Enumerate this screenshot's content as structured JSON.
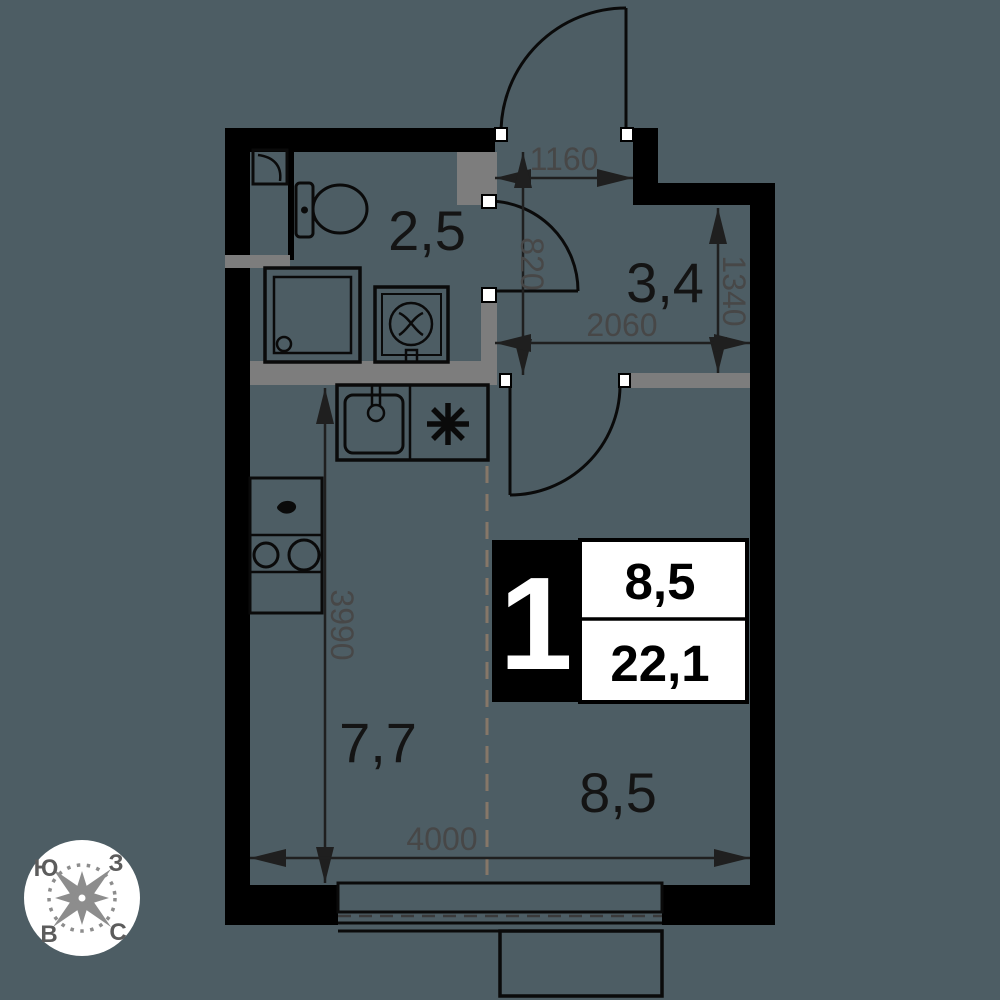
{
  "plan_title": "studio-apartment-floor-plan",
  "colors": {
    "background": "#4d5d64",
    "wall": "#000000",
    "partition": "#7d7d7d",
    "dim": "#1f1f1f",
    "dim_text": "#474747",
    "label_text": "#141414",
    "zone_dash": "#867768",
    "white": "#ffffff",
    "compass_rose": "#8d8d8d",
    "compass_text": "#5c5c5c"
  },
  "rooms": {
    "bathroom": "2,5",
    "hallway": "3,4",
    "kitchen": "7,7",
    "living": "8,5"
  },
  "dimensions": {
    "entrance_width": "1160",
    "bathroom_door_wall": "820",
    "hallway_depth": "1340",
    "hallway_width": "2060",
    "kitchen_zone_depth": "3990",
    "living_width": "4000"
  },
  "info_box": {
    "room_count": "1",
    "living_area": "8,5",
    "total_area": "22,1"
  },
  "compass": {
    "south": "Ю",
    "west": "З",
    "east": "В",
    "north": "С"
  },
  "icons": {
    "stove_symbol": "asterisk-8-ray",
    "sink_symbol": "square-basin-with-faucet",
    "shower_symbol": "square-cabin-with-drain",
    "washer_symbol": "square-with-drum",
    "toilet_symbol": "tank-and-bowl",
    "shaft_symbol": "square-with-curve",
    "hob_symbol": "two-burner-circles",
    "compass_symbol": "eight-point-rose"
  }
}
